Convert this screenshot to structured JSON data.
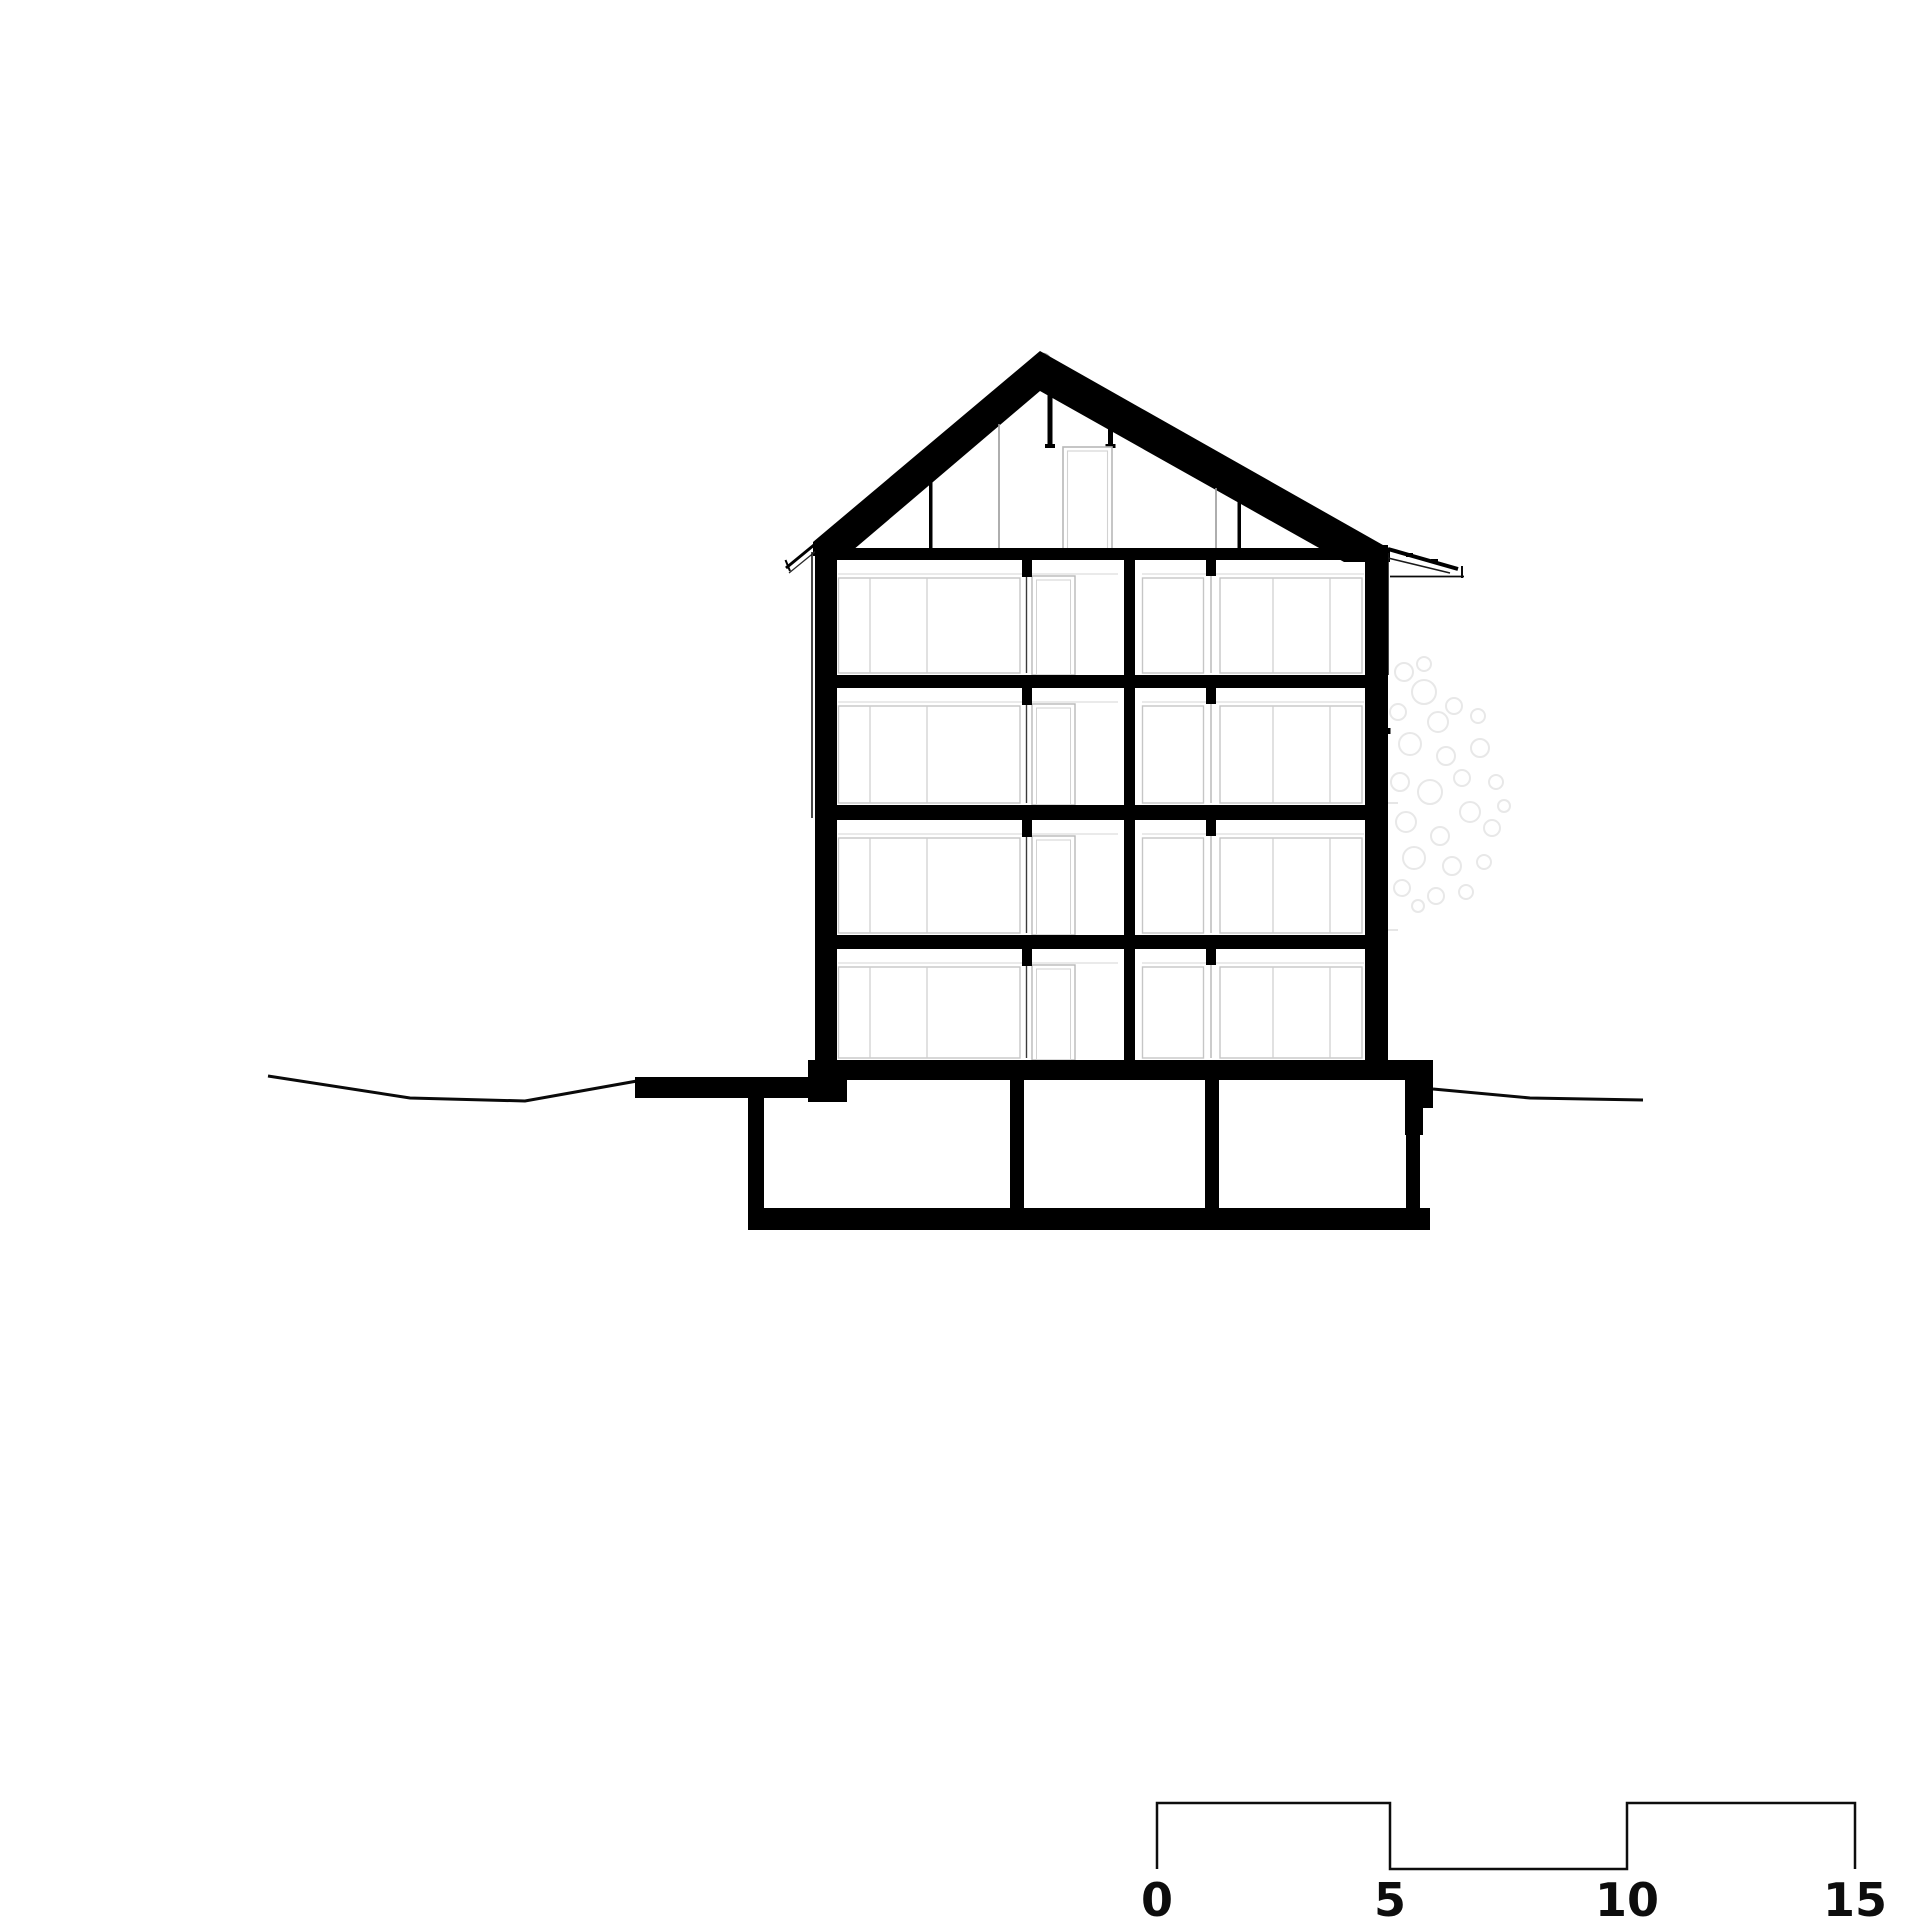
{
  "drawing": {
    "kind": "architectural-cross-section",
    "background_color": "#ffffff",
    "ink_color": "#000000",
    "window_line_gray": "#c6c6c6",
    "faint_line_gray": "#dedede",
    "foliage_gray": "#e8e8e8",
    "storeys_above_ground": 4,
    "attic_storeys": 1,
    "basement_rooms": 3
  },
  "scale_bar": {
    "labels": [
      "0",
      "5",
      "10",
      "15"
    ],
    "interval": 5,
    "max_value": 15
  }
}
